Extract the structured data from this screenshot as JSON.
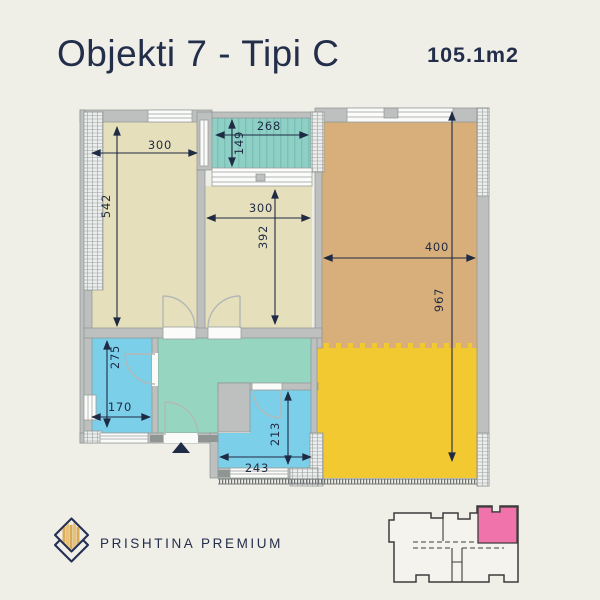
{
  "header": {
    "title": "Objekti 7 - Tipi C",
    "area": "105.1m2"
  },
  "plan": {
    "dimensions": {
      "bedroom1_width": "300",
      "bedroom1_height": "542",
      "balcony_width": "268",
      "balcony_height": "149",
      "bedroom2_width": "300",
      "bedroom2_height": "392",
      "living_width": "400",
      "living_height": "967",
      "bathroom_height": "275",
      "bathroom_width": "170",
      "loggia_height": "213",
      "loggia_width": "243"
    },
    "colors": {
      "bedroom": "#e6dfbc",
      "living": "#d8af7b",
      "terrace": "#f2c930",
      "balcony": "#8ed0c5",
      "hallway": "#96d6c1",
      "wet_rooms": "#7ccfe9",
      "walls": "#bdc0be",
      "dimension": "#1f2a44",
      "minimap_highlight": "#f074ab",
      "logo_gold": "#d9a954"
    }
  },
  "footer": {
    "brand": "PRISHTINA PREMIUM"
  }
}
